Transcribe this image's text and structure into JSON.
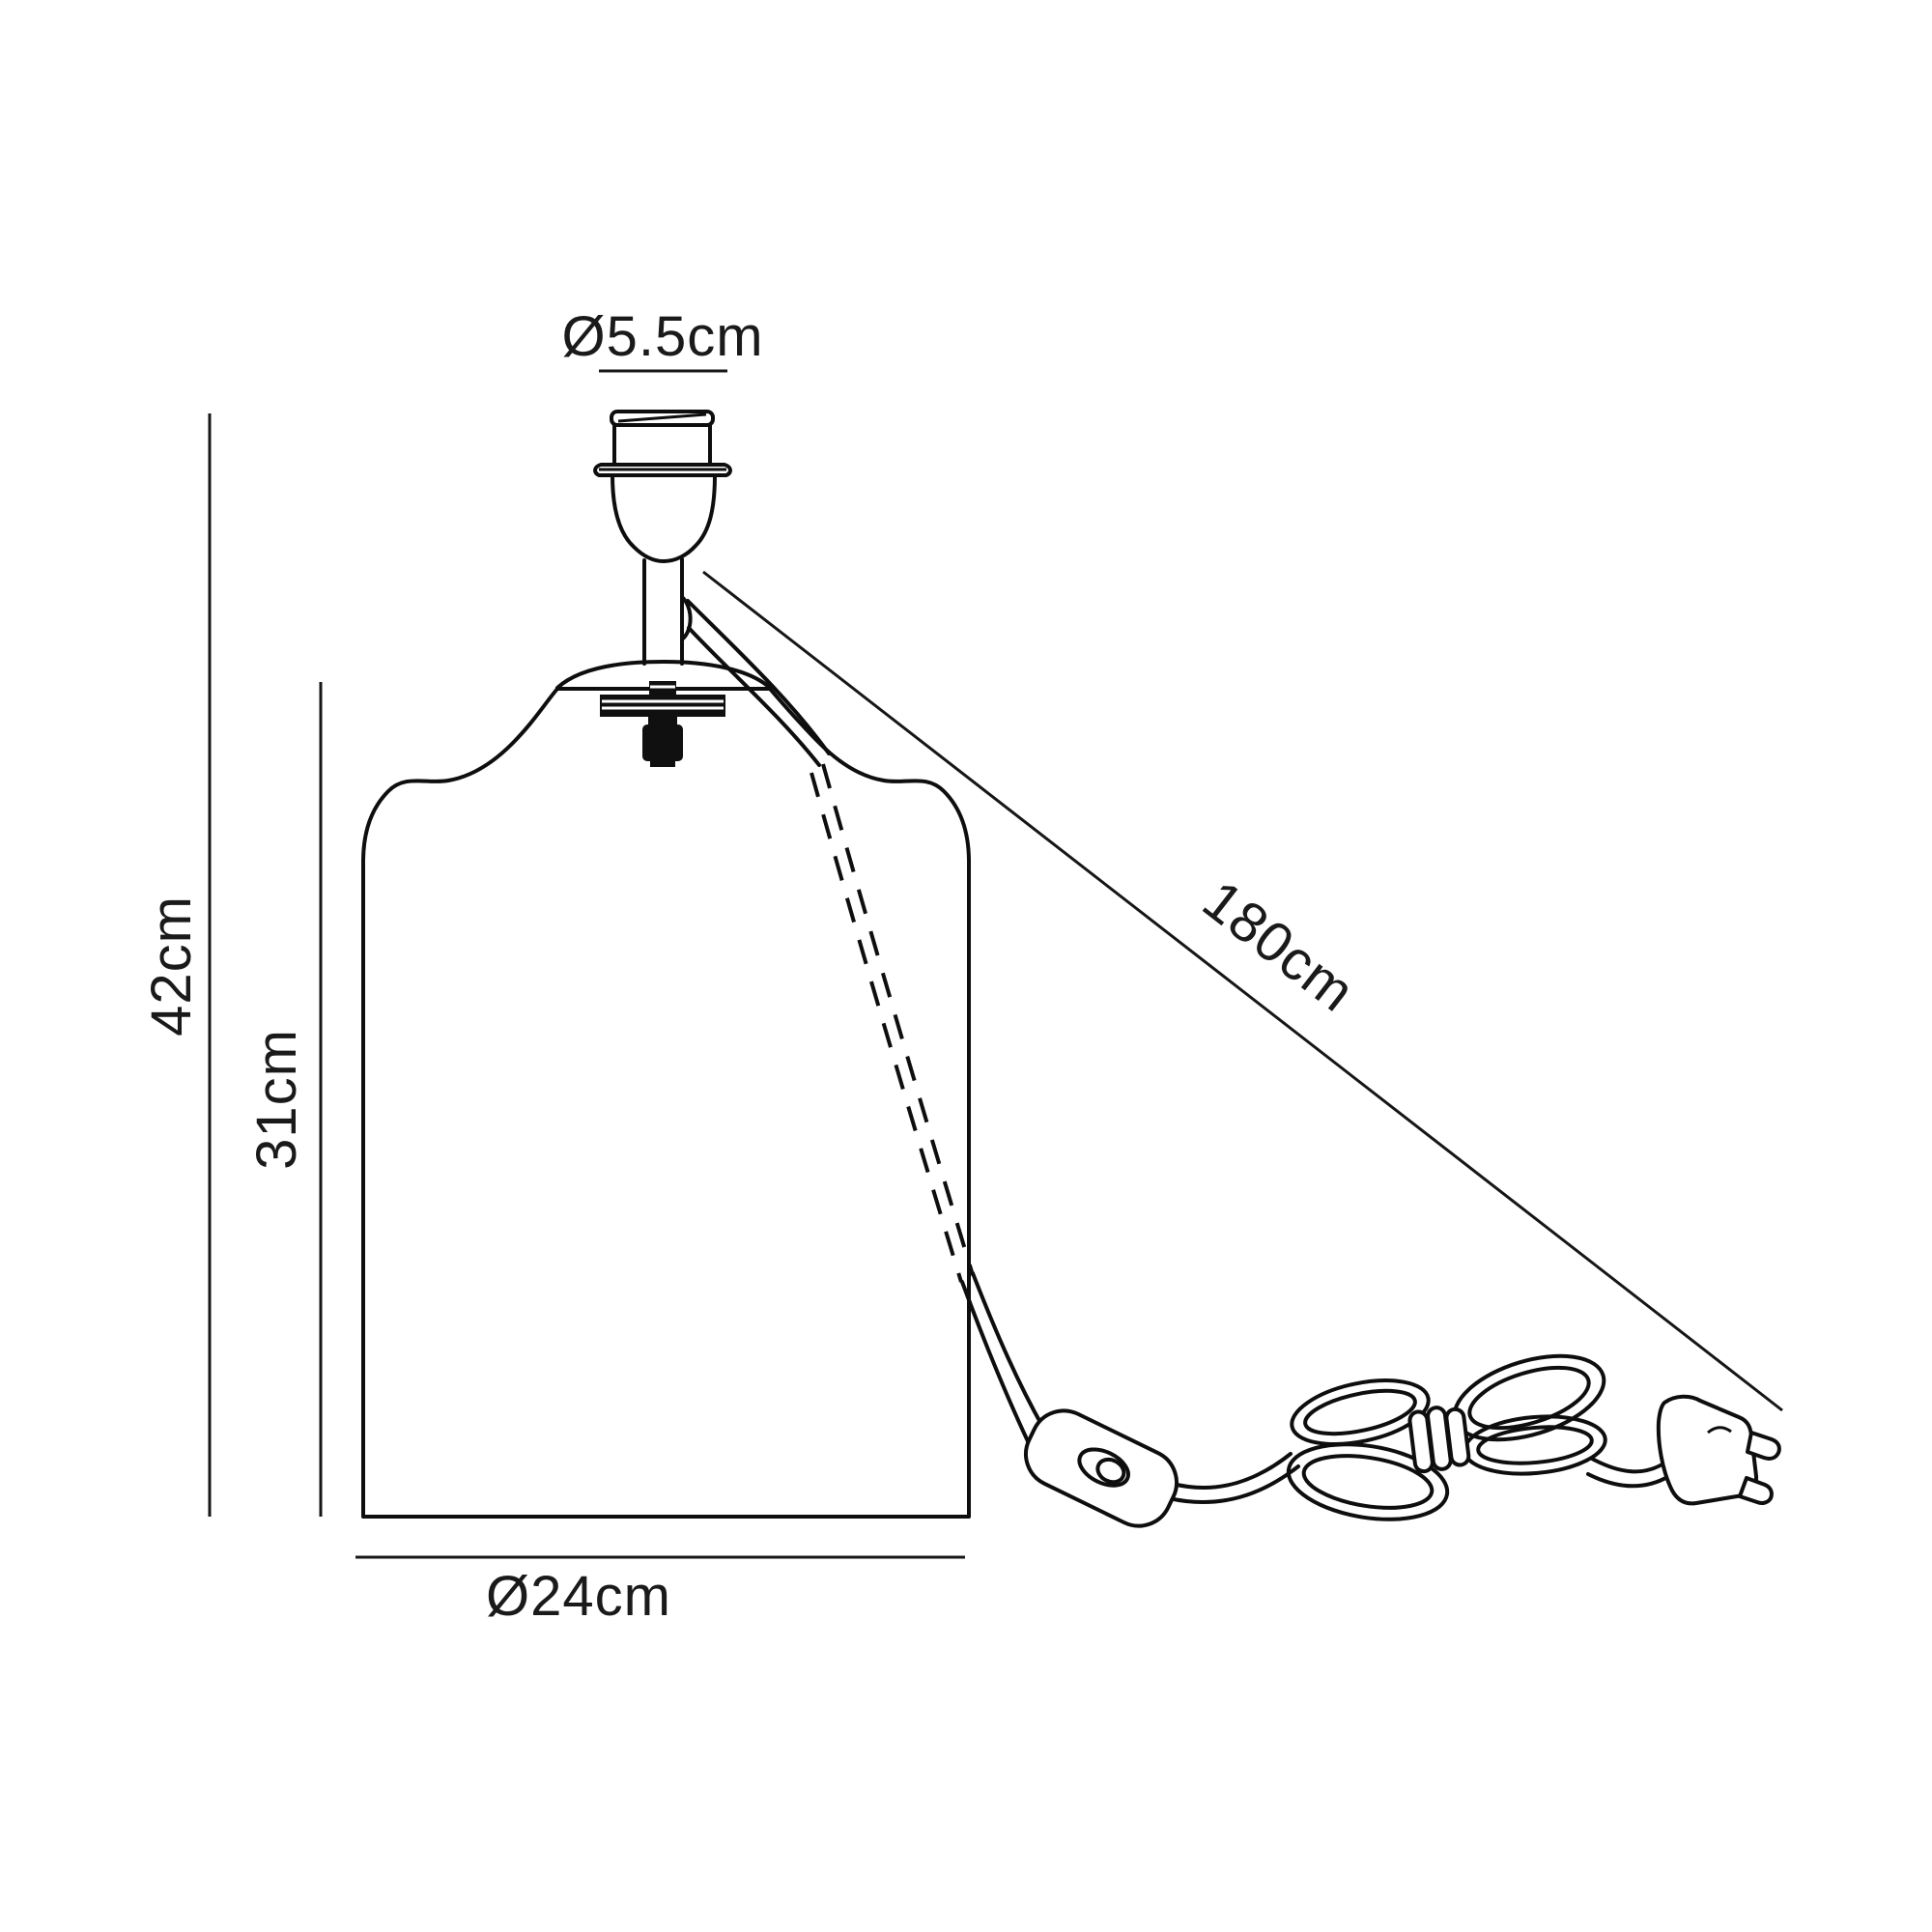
{
  "diagram": {
    "title": "table-lamp-base-dimension-drawing",
    "background_color": "#ffffff",
    "line_color": "#0e0e0e",
    "text_color": "#1a1a1a",
    "labels": {
      "socket_diameter": "Ø5.5cm",
      "overall_height": "42cm",
      "body_height": "31cm",
      "base_diameter": "Ø24cm",
      "cable_length": "180cm"
    }
  }
}
